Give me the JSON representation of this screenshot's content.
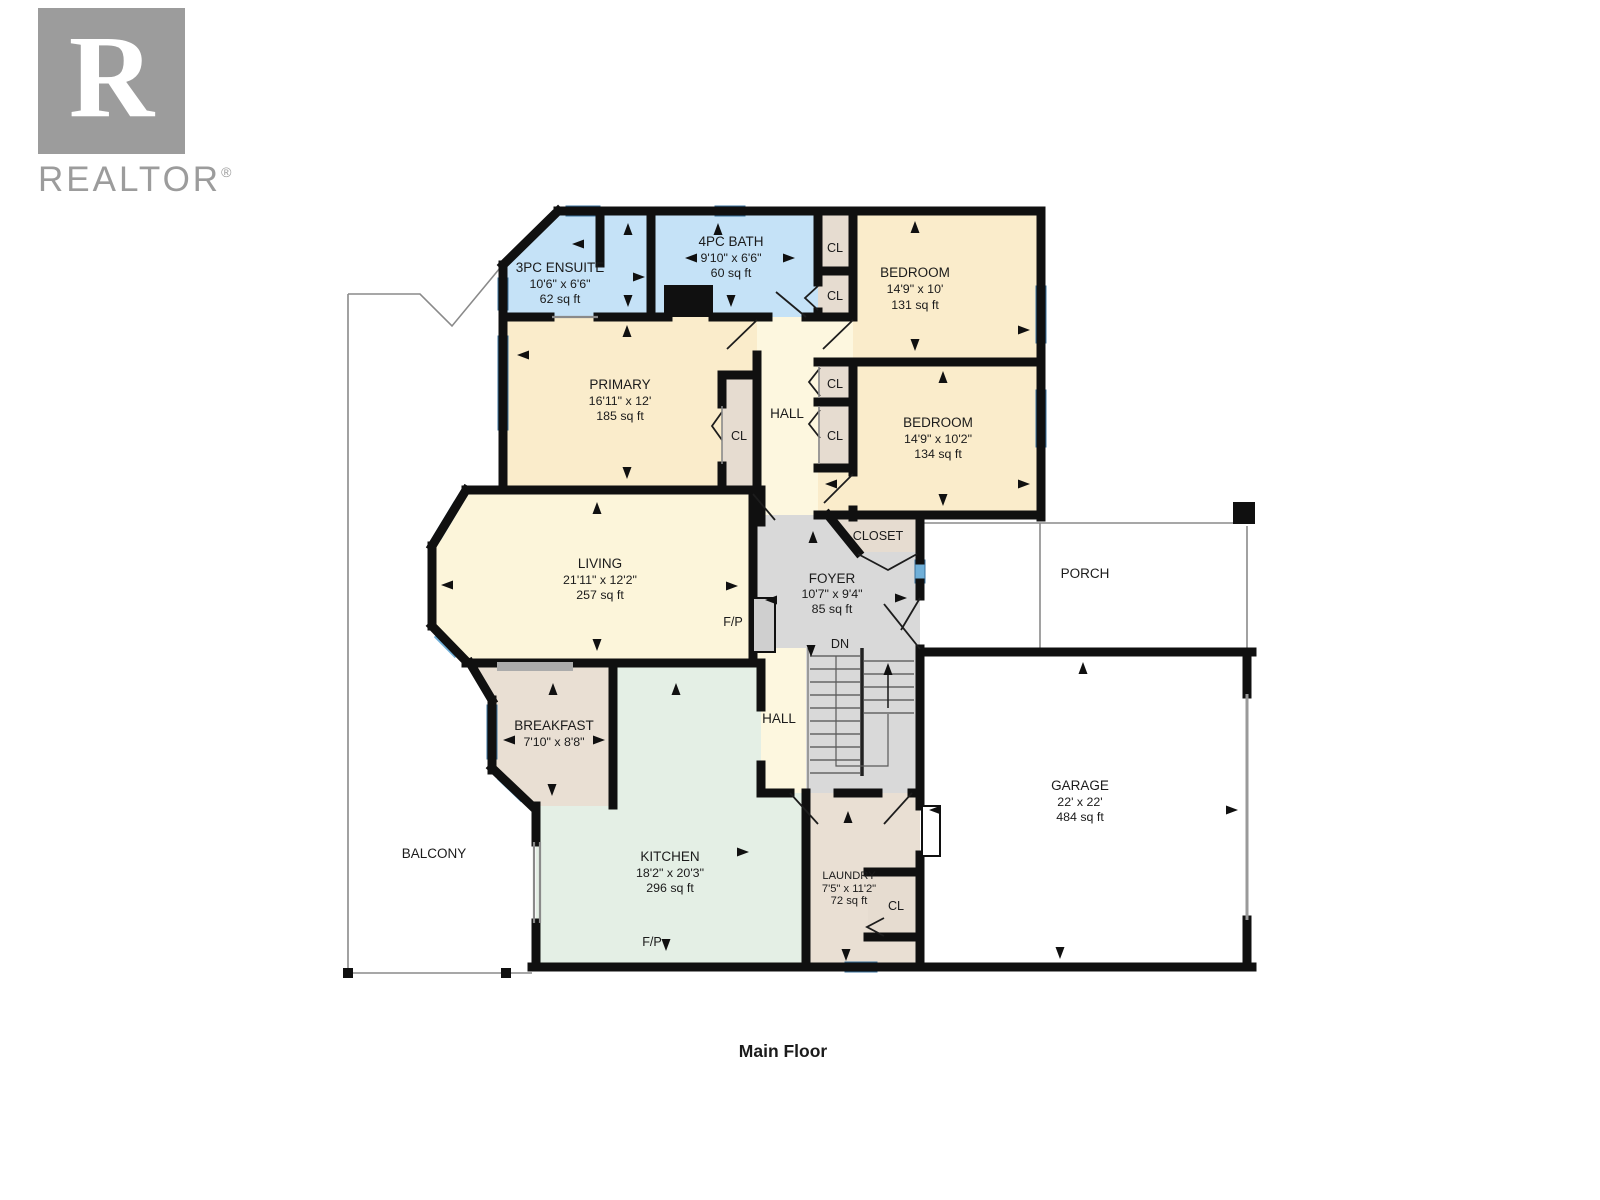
{
  "watermark": {
    "logo_letter": "R",
    "brand": "REALTOR",
    "registered": "®"
  },
  "floor_label": "Main Floor",
  "abbrev": {
    "closet": "CL",
    "fireplace": "F/P",
    "down": "DN"
  },
  "rooms": {
    "ensuite": {
      "name": "3PC ENSUITE",
      "dims": "10'6\" x 6'6\"",
      "area": "62 sq ft"
    },
    "bath": {
      "name": "4PC BATH",
      "dims": "9'10\" x 6'6\"",
      "area": "60 sq ft"
    },
    "bedroom1": {
      "name": "BEDROOM",
      "dims": "14'9\" x 10'",
      "area": "131 sq ft"
    },
    "primary": {
      "name": "PRIMARY",
      "dims": "16'11\" x 12'",
      "area": "185 sq ft"
    },
    "bedroom2": {
      "name": "BEDROOM",
      "dims": "14'9\" x 10'2\"",
      "area": "134 sq ft"
    },
    "living": {
      "name": "LIVING",
      "dims": "21'11\" x 12'2\"",
      "area": "257 sq ft"
    },
    "foyer": {
      "name": "FOYER",
      "dims": "10'7\" x 9'4\"",
      "area": "85 sq ft"
    },
    "entry_closet": {
      "name": "CLOSET"
    },
    "hall_upper": {
      "name": "HALL"
    },
    "hall_lower": {
      "name": "HALL"
    },
    "porch": {
      "name": "PORCH"
    },
    "breakfast": {
      "name": "BREAKFAST",
      "dims": "7'10\" x 8'8\""
    },
    "kitchen": {
      "name": "KITCHEN",
      "dims": "18'2\" x 20'3\"",
      "area": "296 sq ft"
    },
    "laundry": {
      "name": "LAUNDRY",
      "dims": "7'5\" x 11'2\"",
      "area": "72 sq ft"
    },
    "garage": {
      "name": "GARAGE",
      "dims": "22' x 22'",
      "area": "484 sq ft"
    },
    "balcony": {
      "name": "BALCONY"
    }
  },
  "colors": {
    "wall": "#101010",
    "window": "#6fafd8",
    "bath": "#c5e2f7",
    "bedroom": "#faeccb",
    "hall": "#fdf7df",
    "living": "#fcf5da",
    "closet": "#e6dcd0",
    "breakfast": "#e9dfd3",
    "foyer": "#d9d9d9",
    "kitchen": "#e4efe5",
    "white": "#ffffff",
    "logo": "#9c9c9c"
  }
}
